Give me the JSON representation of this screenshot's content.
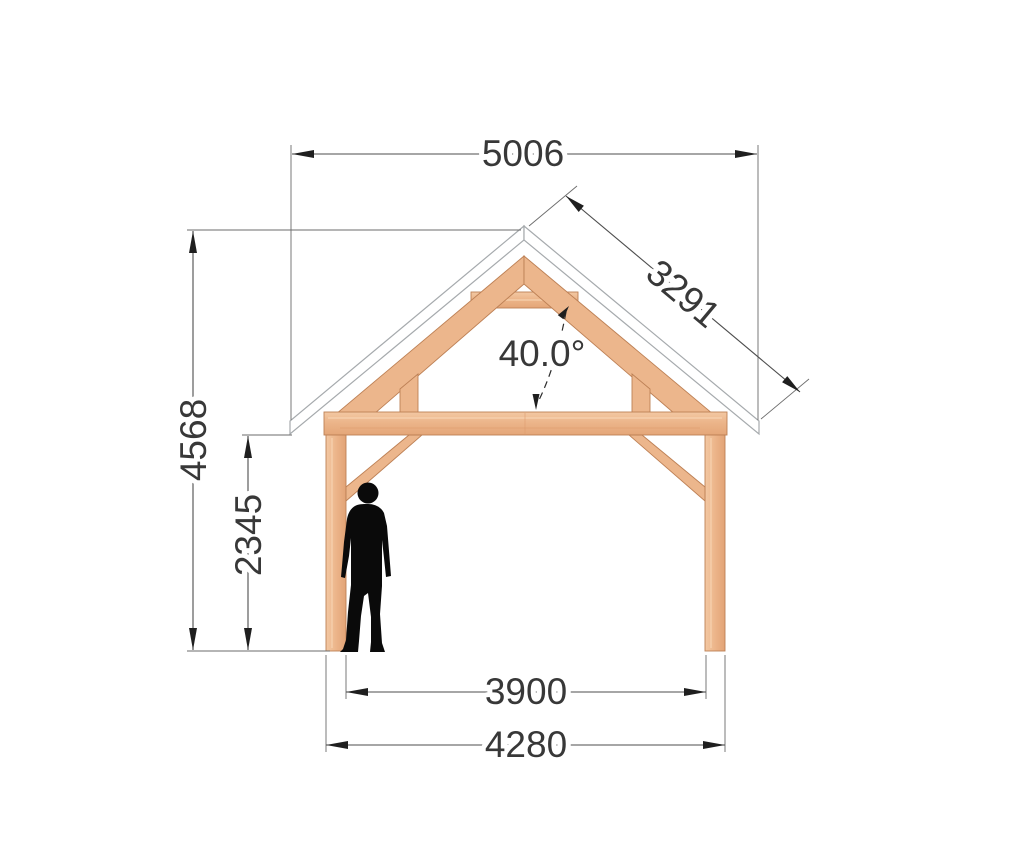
{
  "drawing": {
    "type": "timber-frame front elevation",
    "dimensions": {
      "roof_width": "5006",
      "roof_slope": "3291",
      "roof_angle": "40.0°",
      "height_total": "4568",
      "height_eave": "2345",
      "span_inner": "3900",
      "span_outer": "4280"
    },
    "colors": {
      "wood": "#ecb68c",
      "wood_outline": "#bd8055",
      "roof_panel": "#ffffff",
      "roof_outline": "#a6aaad",
      "dimension_lines": "#4d4d4d",
      "dimension_text": "#383838",
      "silhouette": "#0a0a0a"
    }
  }
}
